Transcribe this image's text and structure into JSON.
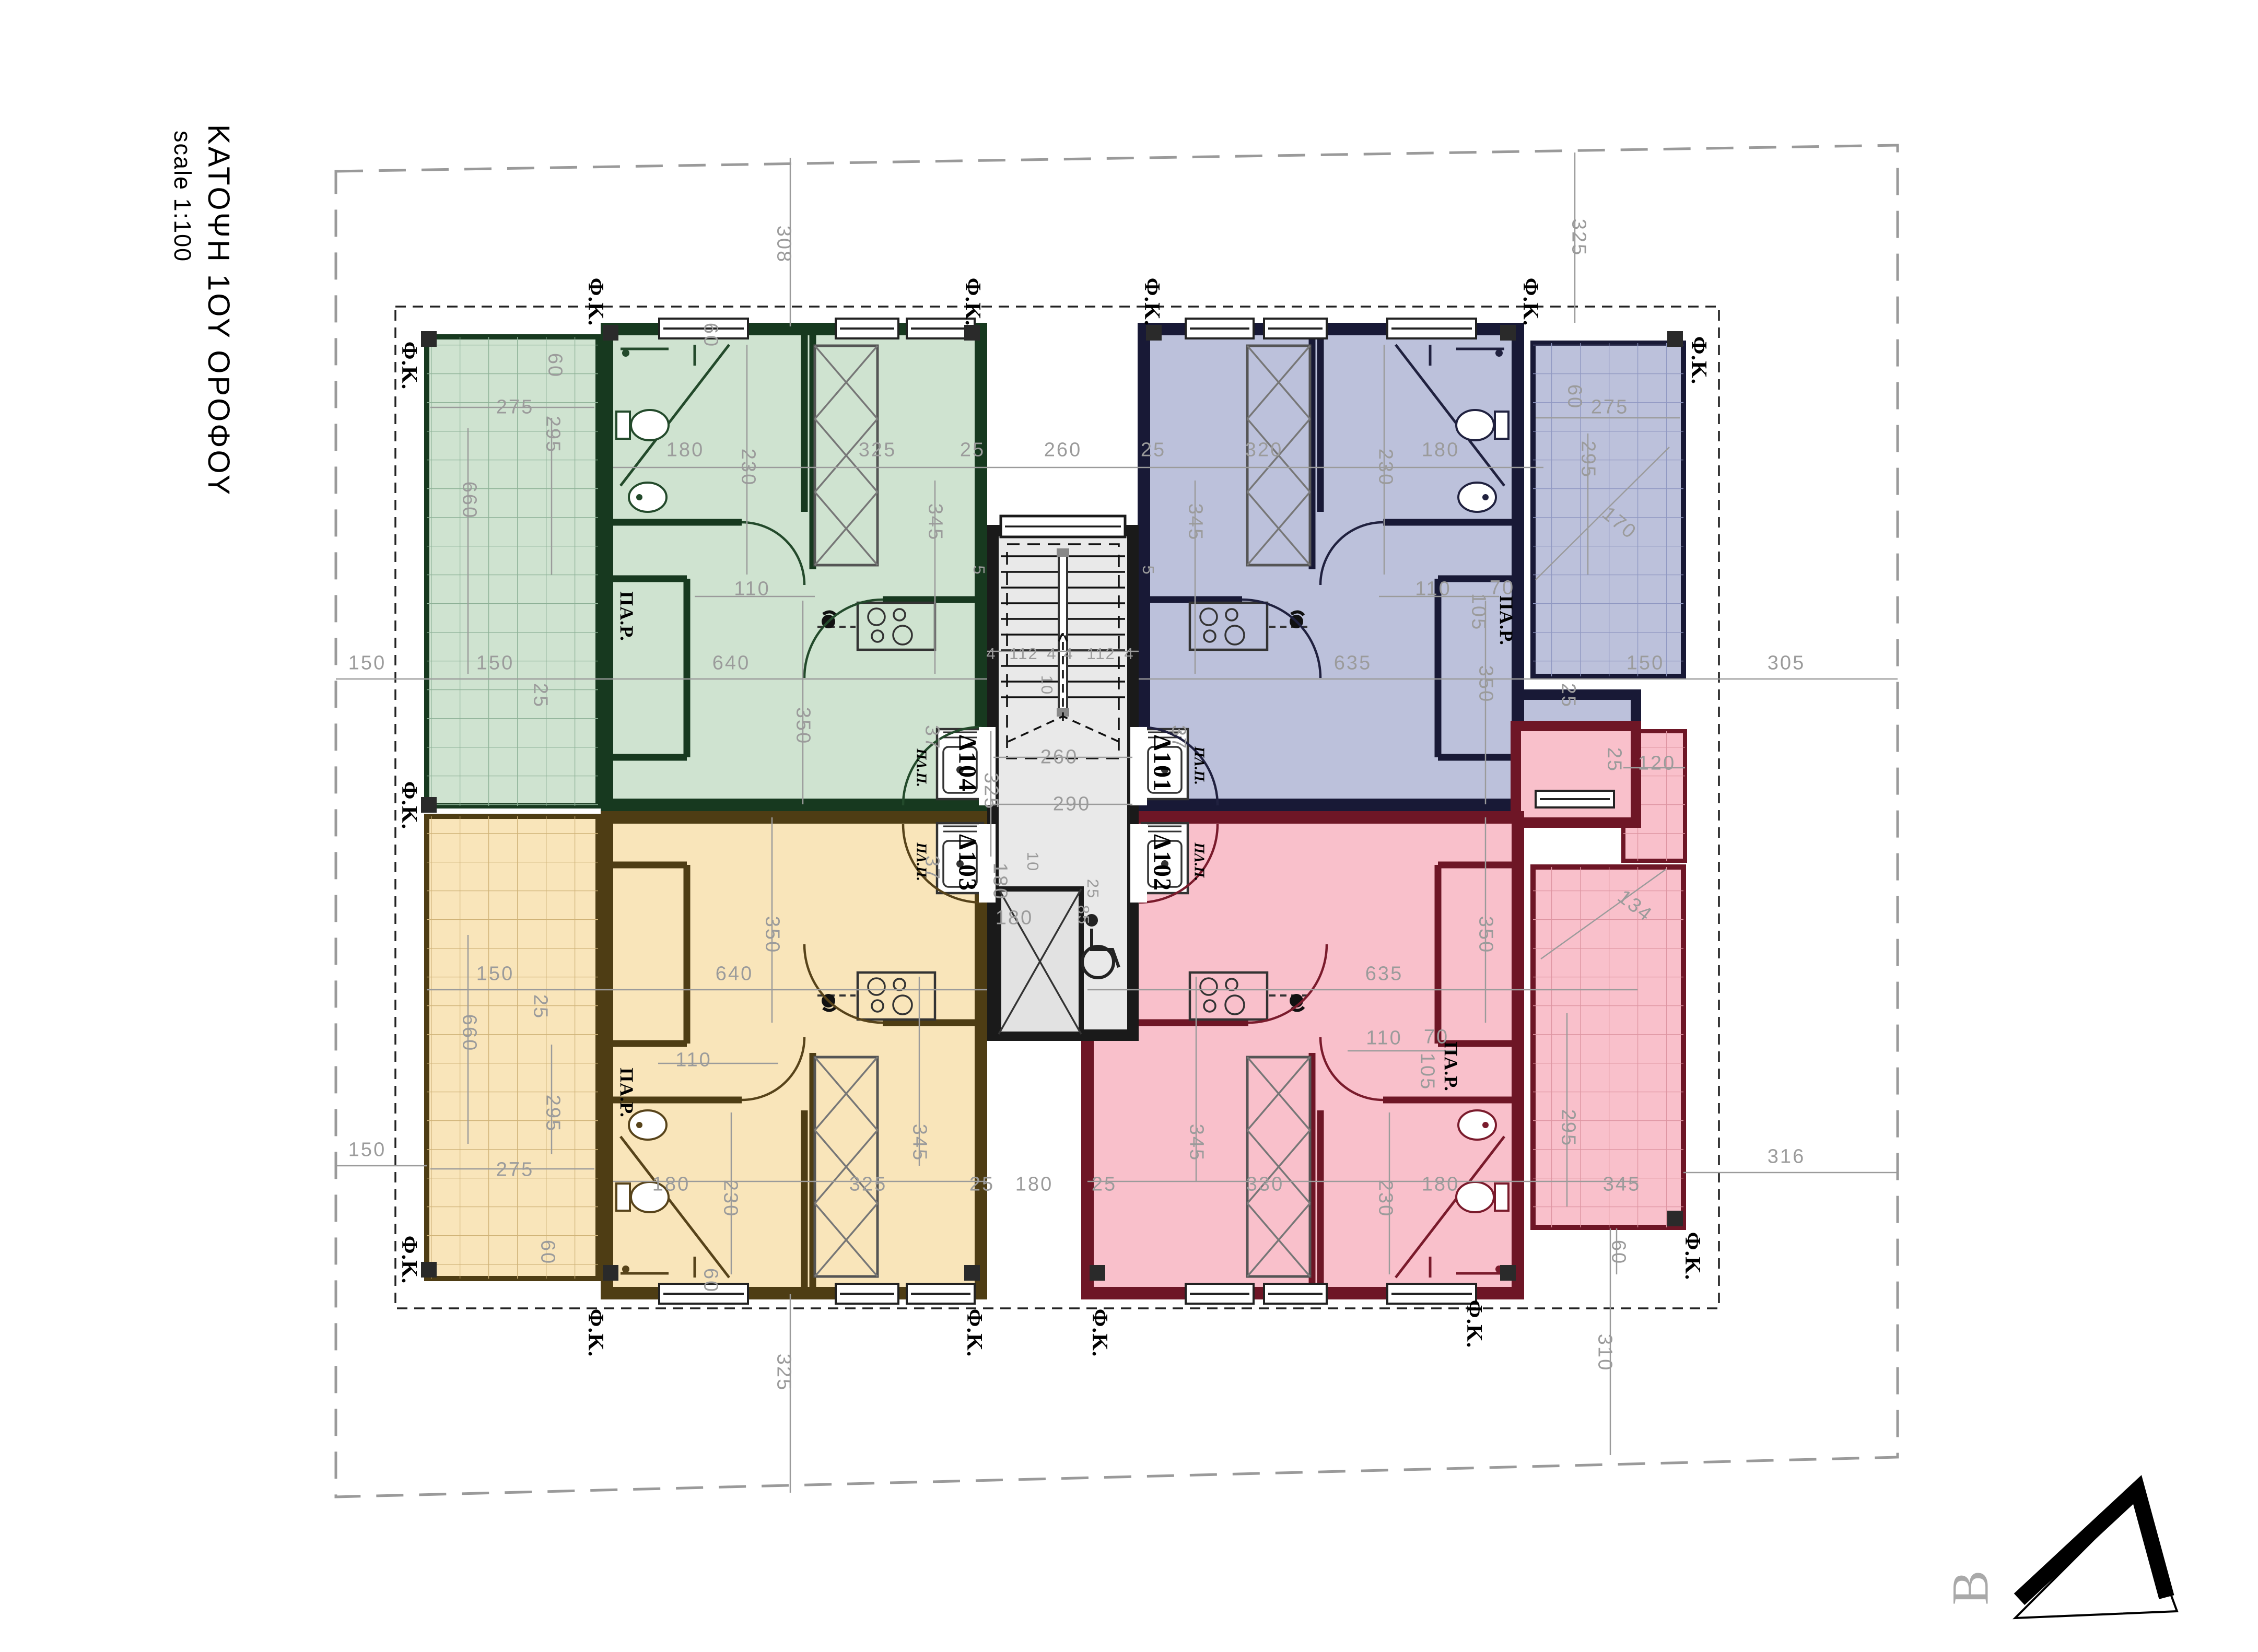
{
  "title": {
    "heading": "ΚΑΤΟΨΗ 1ΟΥ ΟΡΟΦΟΥ",
    "scale_label": "scale 1:100"
  },
  "north_label": "B",
  "annotations": {
    "fk": "Φ.Κ.",
    "par": "ΠΑ.Ρ.",
    "plp": "ΠΛ.Π."
  },
  "apartments": [
    {
      "code": "Δ101",
      "position": "top-right",
      "color_name": "blue"
    },
    {
      "code": "Δ102",
      "position": "bottom-right",
      "color_name": "pink"
    },
    {
      "code": "Δ103",
      "position": "bottom-left",
      "color_name": "yellow"
    },
    {
      "code": "Δ104",
      "position": "top-left",
      "color_name": "green"
    }
  ],
  "dims": {
    "v4": "4",
    "v5": "5",
    "v10": "10",
    "v25": "25",
    "v37": "37",
    "v60": "60",
    "v70": "70",
    "v85": "85",
    "v105": "105",
    "v110": "110",
    "v112": "112",
    "v120": "120",
    "v134": "134",
    "v150": "150",
    "v170": "170",
    "v180": "180",
    "v230": "230",
    "v260": "260",
    "v275": "275",
    "v290": "290",
    "v295": "295",
    "v305": "305",
    "v308": "308",
    "v310": "310",
    "v316": "316",
    "v320": "320",
    "v325": "325",
    "v330": "330",
    "v345": "345",
    "v350": "350",
    "v635": "635",
    "v640": "640",
    "v660": "660"
  },
  "colors": {
    "green_fill": "#cfe3d0",
    "green_wall": "#17391f",
    "green_grid": "#8db196",
    "blue_fill": "#bcc1db",
    "blue_wall": "#181936",
    "blue_grid": "#9098c2",
    "yellow_fill": "#f9e5ba",
    "yellow_wall": "#4e3d14",
    "yellow_grid": "#cfb277",
    "pink_fill": "#f9c0cb",
    "pink_wall": "#6e1626",
    "pink_grid": "#de95a2",
    "core_fill": "#e9e9e9",
    "line": "#9b9b9b",
    "ink": "#111111"
  }
}
